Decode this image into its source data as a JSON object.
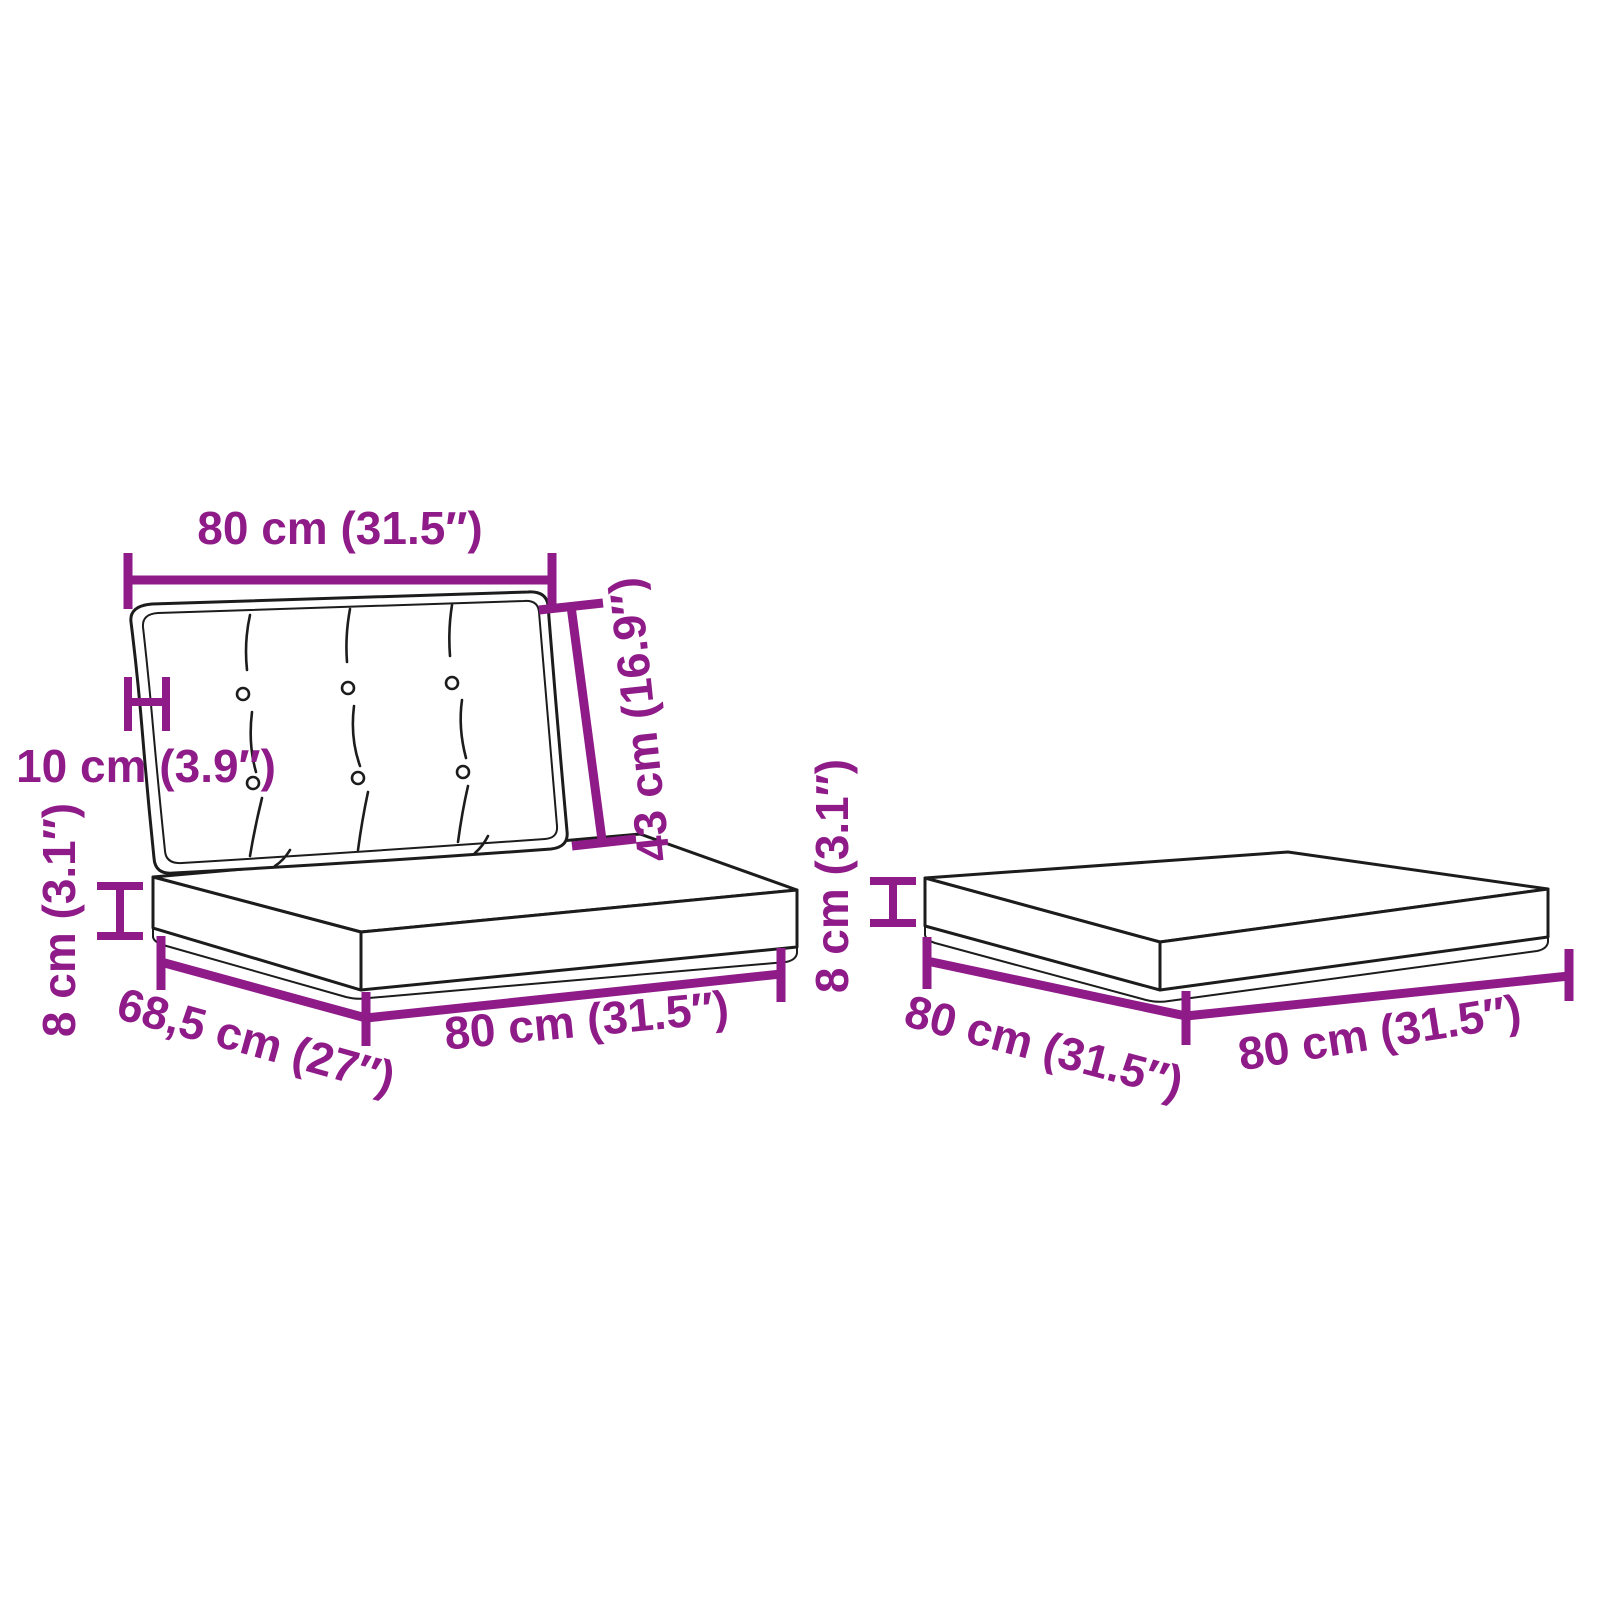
{
  "page": {
    "background": "#FFFFFF"
  },
  "colors": {
    "dimension_annotation": "#8E1B88",
    "line_art": "#1C1C1C"
  },
  "figures": {
    "cushion_set": {
      "name": "pallet cushion set with backrest (tufted back cushion on seat cushion)",
      "dims": {
        "backrest_width": "80 cm (31.5″)",
        "backrest_height": "43 cm (16.9″)",
        "backrest_thickness": "10 cm (3.9″)",
        "seat_thickness": "8 cm (3.1″)",
        "seat_depth": "68,5 cm (27″)",
        "seat_front_width": "80 cm (31.5″)"
      }
    },
    "single_cushion": {
      "name": "flat pallet seat cushion",
      "dims": {
        "thickness": "8 cm (3.1″)",
        "depth": "80 cm (31.5″)",
        "width": "80 cm (31.5″)"
      }
    }
  }
}
